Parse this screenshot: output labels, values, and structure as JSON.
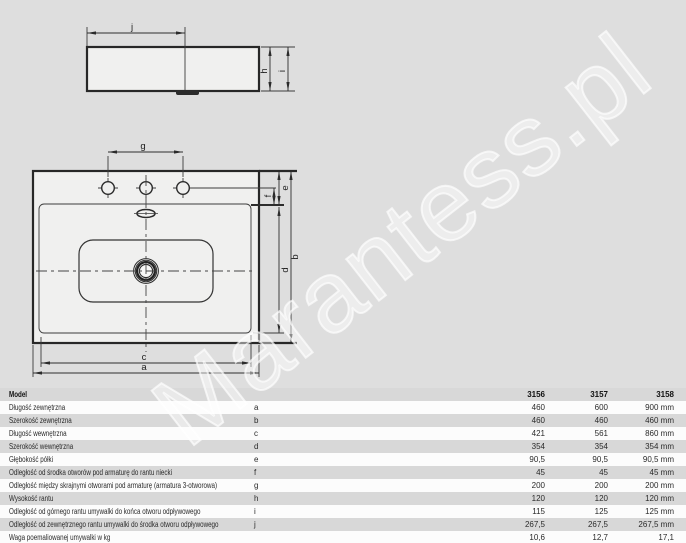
{
  "watermark": {
    "text": "Marantess.pl"
  },
  "diagram": {
    "side_view": {
      "j": "j",
      "h": "h",
      "i": "i"
    },
    "top_view": {
      "g": "g",
      "e": "e",
      "f": "f",
      "b": "b",
      "d": "d",
      "c": "c",
      "a": "a"
    }
  },
  "table": {
    "header": {
      "label": "Model",
      "models": [
        "3156",
        "3157",
        "3158"
      ]
    },
    "rows": [
      {
        "label": "Długość zewnętrzna",
        "letter": "a",
        "v1": "460",
        "v2": "600",
        "v3": "900 mm"
      },
      {
        "label": "Szerokość zewnętrzna",
        "letter": "b",
        "v1": "460",
        "v2": "460",
        "v3": "460 mm"
      },
      {
        "label": "Długość wewnętrzna",
        "letter": "c",
        "v1": "421",
        "v2": "561",
        "v3": "860 mm"
      },
      {
        "label": "Szerokość wewnętrzna",
        "letter": "d",
        "v1": "354",
        "v2": "354",
        "v3": "354 mm"
      },
      {
        "label": "Głębokość półki",
        "letter": "e",
        "v1": "90,5",
        "v2": "90,5",
        "v3": "90,5 mm"
      },
      {
        "label": "Odległość od środka otworów pod armaturę do rantu niecki",
        "letter": "f",
        "v1": "45",
        "v2": "45",
        "v3": "45 mm"
      },
      {
        "label": "Odległość między skrajnymi otworami pod armaturę (armatura 3-otworowa)",
        "letter": "g",
        "v1": "200",
        "v2": "200",
        "v3": "200 mm"
      },
      {
        "label": "Wysokość rantu",
        "letter": "h",
        "v1": "120",
        "v2": "120",
        "v3": "120 mm"
      },
      {
        "label": "Odległość od górnego rantu umywalki do końca otworu odpływowego",
        "letter": "i",
        "v1": "115",
        "v2": "125",
        "v3": "125 mm"
      },
      {
        "label": "Odległość od zewnętrznego rantu umywalki do środka otworu odpływowego",
        "letter": "j",
        "v1": "267,5",
        "v2": "267,5",
        "v3": "267,5 mm"
      },
      {
        "label": "Waga poemaliowanej umywalki w kg",
        "letter": "",
        "v1": "10,6",
        "v2": "12,7",
        "v3": "17,1"
      }
    ]
  },
  "colors": {
    "background": "#dedede",
    "row_gray": "#d8d8d8",
    "row_white": "#fcfcfc",
    "line": "#2b2b2b",
    "shape_fill": "#f0f0ef"
  }
}
